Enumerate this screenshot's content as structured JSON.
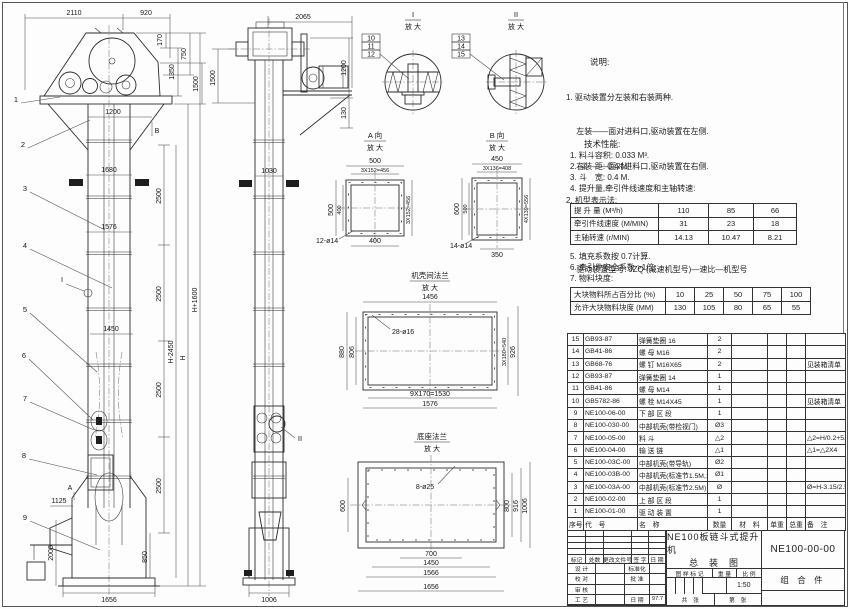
{
  "drawing": {
    "front": {
      "top_dims": [
        "2110",
        "920"
      ],
      "head_dims": [
        "170",
        "1350",
        "750",
        "1500"
      ],
      "inner_dims": [
        "1200",
        "1680",
        "1576",
        "1450",
        "1125",
        "2000",
        "850",
        "1656"
      ],
      "chain_dims": [
        "2500",
        "2500",
        "2500",
        "2500"
      ],
      "tall_dims": [
        "H-2450",
        "H",
        "H+1600"
      ],
      "labels": [
        "1",
        "2",
        "3",
        "4",
        "5",
        "6",
        "7",
        "8",
        "9"
      ],
      "marks": [
        "I",
        "A",
        "B"
      ]
    },
    "side": {
      "dims": [
        "2065",
        "1500",
        "1030",
        "1006",
        "1200",
        "130"
      ],
      "marks": [
        "II"
      ]
    },
    "d1": {
      "title": "I",
      "sub": "放 大",
      "labels": [
        "10",
        "11",
        "12"
      ]
    },
    "d2": {
      "title": "II",
      "sub": "放 大",
      "labels": [
        "13",
        "14",
        "15"
      ]
    },
    "viewA": {
      "title": "A 向",
      "sub": "放 大",
      "dims": [
        "500",
        "3X152=456",
        "500",
        "400",
        "3X152=456",
        "400",
        "12-ø14"
      ]
    },
    "viewB": {
      "title": "B 向",
      "sub": "放 大",
      "dims": [
        "450",
        "3X136=408",
        "600",
        "500",
        "4X139=556",
        "350",
        "14-ø14"
      ]
    },
    "flange": {
      "title": "机壳间法兰",
      "sub": "放 大",
      "dims": [
        "1456",
        "28-ø16",
        "880",
        "806",
        "3X180=540",
        "926",
        "9X170=1530",
        "1576"
      ]
    },
    "base": {
      "title": "底座法兰",
      "sub": "放 大",
      "dims": [
        "8-ø25",
        "600",
        "800",
        "916",
        "1006",
        "700",
        "1450",
        "1566",
        "1656"
      ]
    }
  },
  "notes": {
    "title": "说明:",
    "items": [
      "1. 驱动装置分左装和右装两种.",
      "　 左装——面对进料口,驱动装置在左侧.",
      "　 右装——面对进料口,驱动装置在右侧.",
      "2. 机型表示法:",
      "　 NE100——提升机高度H(M)——提升量(M³/h)——左(右)装.",
      "　 驱动装置型号: JZQ (减速机型号)—速比—机型号",
      "　 　 　 　 Y (电动机型号)—极数—功率"
    ]
  },
  "specs": {
    "title": "技术性能:",
    "items": [
      "1. 料斗容积: 0.033 M³.",
      "2. 斗　距: 0.4 M.",
      "3. 斗　宽: 0.4 M.",
      "4. 提升量,牵引件线速度和主轴转速:"
    ],
    "table1": {
      "rows": [
        [
          "提 升 量 (M³/h)",
          "110",
          "85",
          "66"
        ],
        [
          "牵引件线速度 (M/MIN)",
          "31",
          "23",
          "18"
        ],
        [
          "主轴转速 (r/MIN)",
          "14.13",
          "10.47",
          "8.21"
        ]
      ]
    },
    "items2": [
      "5. 填充系数按 0.7计算.",
      "6. 牵引件安全系数 >1倍.",
      "7. 物料块度:"
    ],
    "table2": {
      "rows": [
        [
          "大块物料所占百分比 (%)",
          "10",
          "25",
          "50",
          "75",
          "100"
        ],
        [
          "允许大块物料块度 (MM)",
          "130",
          "105",
          "80",
          "65",
          "55"
        ]
      ]
    }
  },
  "bom": {
    "rows": [
      [
        "15",
        "GB93-87",
        "弹簧垫圈  16",
        "2",
        "",
        "",
        "",
        ""
      ],
      [
        "14",
        "GB41-86",
        "螺 母  M16",
        "2",
        "",
        "",
        "",
        ""
      ],
      [
        "13",
        "GB68-76",
        "螺 钉  M16X65",
        "2",
        "",
        "",
        "",
        "见装箱清单"
      ],
      [
        "12",
        "GB93-87",
        "弹簧垫圈  14",
        "1",
        "",
        "",
        "",
        ""
      ],
      [
        "11",
        "GB41-86",
        "螺 母  M14",
        "1",
        "",
        "",
        "",
        ""
      ],
      [
        "10",
        "GB5782-86",
        "螺 栓  M14X45",
        "1",
        "",
        "",
        "",
        "见装箱清单"
      ],
      [
        "9",
        "NE100-06-00",
        "下 部 区 段",
        "1",
        "",
        "",
        "",
        ""
      ],
      [
        "8",
        "NE100-030-00",
        "中部机壳(带检视门)",
        "Ø3",
        "",
        "",
        "",
        ""
      ],
      [
        "7",
        "NE100-05-00",
        "料  斗",
        "△2",
        "",
        "",
        "",
        "△2=H/0.2+5.75"
      ],
      [
        "6",
        "NE100-04-00",
        "输 送 链",
        "△1",
        "",
        "",
        "",
        "△1=△2X4"
      ],
      [
        "5",
        "NE100-03C-00",
        "中部机壳(带导轨)",
        "Ø2",
        "",
        "",
        "",
        ""
      ],
      [
        "4",
        "NE100-03B-00",
        "中部机壳(标准节1.5M,1M)",
        "Ø1",
        "",
        "",
        "",
        ""
      ],
      [
        "3",
        "NE100-03A-00",
        "中部机壳(标准节2.5M)",
        "Ø",
        "",
        "",
        "",
        "Ø=H-3.15/2.5"
      ],
      [
        "2",
        "NE100-02-00",
        "上 部 区 段",
        "1",
        "",
        "",
        "",
        ""
      ],
      [
        "1",
        "NE100-01-00",
        "驱 动 装 置",
        "1",
        "",
        "",
        "",
        ""
      ]
    ],
    "footer": [
      [
        "序号",
        "代　号",
        "名　称",
        "数量",
        "材　料",
        "单重",
        "总重",
        "备　注"
      ]
    ]
  },
  "titleblock": {
    "product": "NE100板链斗式提升机",
    "sheet_name": "总　装　图",
    "drawing_no": "NE100-00-00",
    "part_type": "组 合 件",
    "scale": "1:50",
    "rev_header": [
      "标记",
      "处数",
      "更改文件号",
      "签 字",
      "日 期"
    ],
    "roles": [
      [
        "设 计",
        "",
        "标准化",
        ""
      ],
      [
        "校 对",
        "",
        "批 准",
        ""
      ],
      [
        "审 核",
        "",
        "",
        ""
      ],
      [
        "工 艺",
        "",
        "日 期",
        "97.7"
      ]
    ],
    "stamp_label": "图 样 标 记",
    "weight_label": "重 量",
    "scale_label": "比 例",
    "total_label": "共　张",
    "page_label": "第　张"
  }
}
